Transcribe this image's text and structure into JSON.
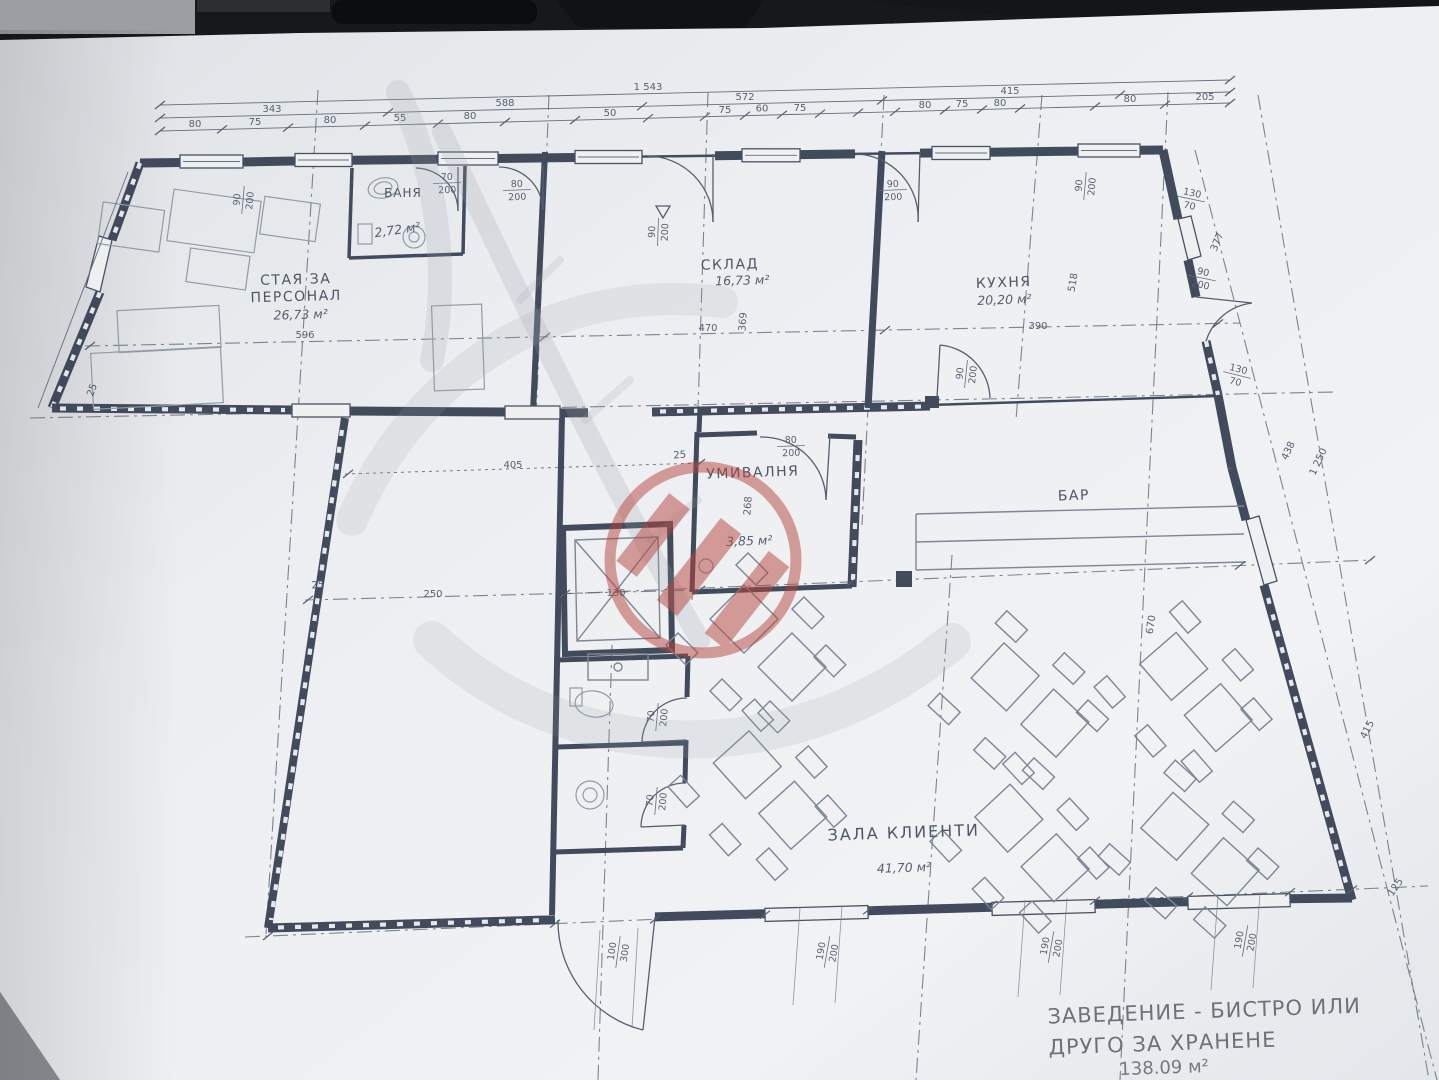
{
  "document": {
    "kind": "architectural floor plan photo",
    "language": "Bulgarian"
  },
  "colors": {
    "paper": "#eceef1",
    "ink": "#343f51",
    "dim_text": "#4b5566",
    "watermark_red": "#b5443c",
    "watermark_gray": "#9aa0a8"
  },
  "rooms": {
    "staff": {
      "line1": "СТАЯ ЗА",
      "line2": "ПЕРСОНАЛ",
      "area": "26,73 м²"
    },
    "bath": {
      "name": "БАНЯ",
      "area": "2,72 м²"
    },
    "storage": {
      "name": "СКЛАД",
      "area": "16,73 м²"
    },
    "kitchen": {
      "name": "КУХНЯ",
      "area": "20,20 м²"
    },
    "washroom": {
      "name": "УМИВАЛНЯ",
      "area": "3,85 м²"
    },
    "bar": {
      "name": "БАР"
    },
    "hall": {
      "name": "ЗАЛА КЛИЕНТИ",
      "area": "41,70 м²"
    }
  },
  "summary": {
    "line1": "ЗАВЕДЕНИЕ - БИСТРО ИЛИ",
    "line2": "ДРУГО ЗА ХРАНЕНЕ",
    "area": "138.09 м²"
  },
  "dims": {
    "total": "1 543",
    "row2": {
      "a": "343",
      "b": "588",
      "c": "572",
      "d": "415"
    },
    "chain": [
      "80",
      "75",
      "80",
      "55",
      "80",
      "50",
      "75",
      "60",
      "75",
      "80",
      "75",
      "80",
      "80",
      "205"
    ],
    "staff_w": "596",
    "storage_w": "470",
    "kitchen_w": "390",
    "hall_w": "405",
    "left_w": "250",
    "elevator_w": "130",
    "storage_h": "369",
    "wash_h": "268",
    "kitchen_h": "518",
    "right_upper": "377",
    "right_mid": "438",
    "right_total": "1 250",
    "right_lower": "415",
    "hall_h": "670",
    "tick": "25",
    "corner": "125"
  },
  "openings": {
    "bath_door": {
      "w": "70",
      "h": "200"
    },
    "bath_door2": {
      "w": "80",
      "h": "200"
    },
    "storage_door": {
      "w": "90",
      "h": "200"
    },
    "kitchen_door": {
      "w": "90",
      "h": "200"
    },
    "kitchen_bar_door": {
      "w": "90",
      "h": "200"
    },
    "wash_door": {
      "w": "80",
      "h": "200"
    },
    "side_door": {
      "w": "90",
      "h": "200"
    },
    "wc_door1": {
      "w": "70",
      "h": "200"
    },
    "wc_door2": {
      "w": "70",
      "h": "200"
    },
    "entrance_door": {
      "w": "100",
      "h": "300"
    },
    "window_top1": {
      "w": "90",
      "h": "200"
    },
    "window_top2": {
      "w": "90",
      "h": "200"
    },
    "window_east1": {
      "w": "130",
      "h": "70"
    },
    "window_east2": {
      "w": "130",
      "h": "70"
    },
    "window_south1": {
      "w": "190",
      "h": "200"
    },
    "window_south2": {
      "w": "190",
      "h": "200"
    },
    "window_south3": {
      "w": "190",
      "h": "200"
    }
  }
}
